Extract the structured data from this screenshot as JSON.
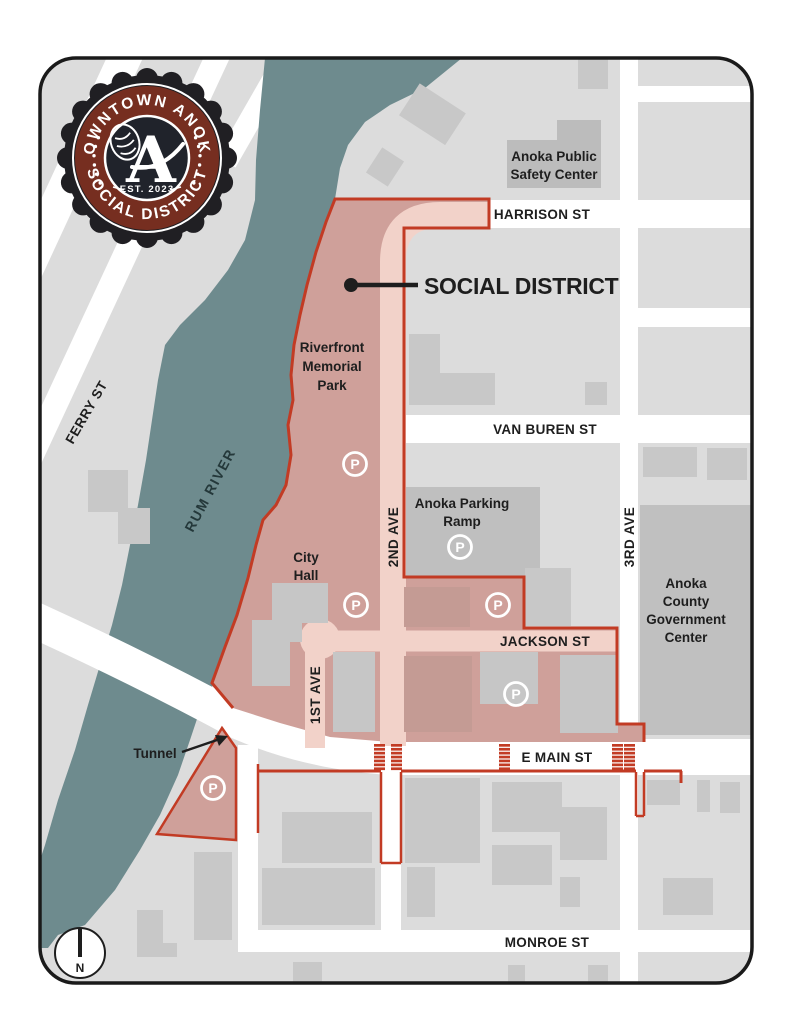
{
  "logo": {
    "arc_top": "DOWNTOWN ANOKA",
    "arc_bottom": "SOCIAL DISTRICT",
    "est": "EST. 2023",
    "monogram": "A"
  },
  "callout": {
    "social_district": "SOCIAL DISTRICT",
    "tunnel": "Tunnel"
  },
  "streets": {
    "harrison": "HARRISON ST",
    "van_buren": "VAN BUREN ST",
    "jackson": "JACKSON ST",
    "e_main": "E MAIN ST",
    "monroe": "MONROE ST",
    "ferry": "FERRY ST",
    "first_ave": "1ST AVE",
    "second_ave": "2ND AVE",
    "third_ave": "3RD AVE"
  },
  "river": {
    "name": "RUM RIVER"
  },
  "places": {
    "safety_center": {
      "lines": [
        "Anoka Public",
        "Safety Center"
      ]
    },
    "memorial_park": {
      "lines": [
        "Riverfront",
        "Memorial",
        "Park"
      ]
    },
    "parking_ramp": {
      "lines": [
        "Anoka Parking",
        "Ramp"
      ]
    },
    "city_hall": {
      "lines": [
        "City",
        "Hall"
      ]
    },
    "gov_center": {
      "lines": [
        "Anoka",
        "County",
        "Government",
        "Center"
      ]
    }
  },
  "parking": {
    "symbol": "P"
  },
  "compass": {
    "north": "N"
  },
  "colors": {
    "district_fill": "#cfa09a",
    "district_street": "#f2d2c9",
    "boundary_red": "#c23b24",
    "river_teal": "#6e8b8e",
    "map_gray": "#dcdcdc",
    "building_gray": "#c8c8c8",
    "street_white": "#ffffff",
    "logo_maroon": "#762e20",
    "logo_dark": "#20232b"
  }
}
